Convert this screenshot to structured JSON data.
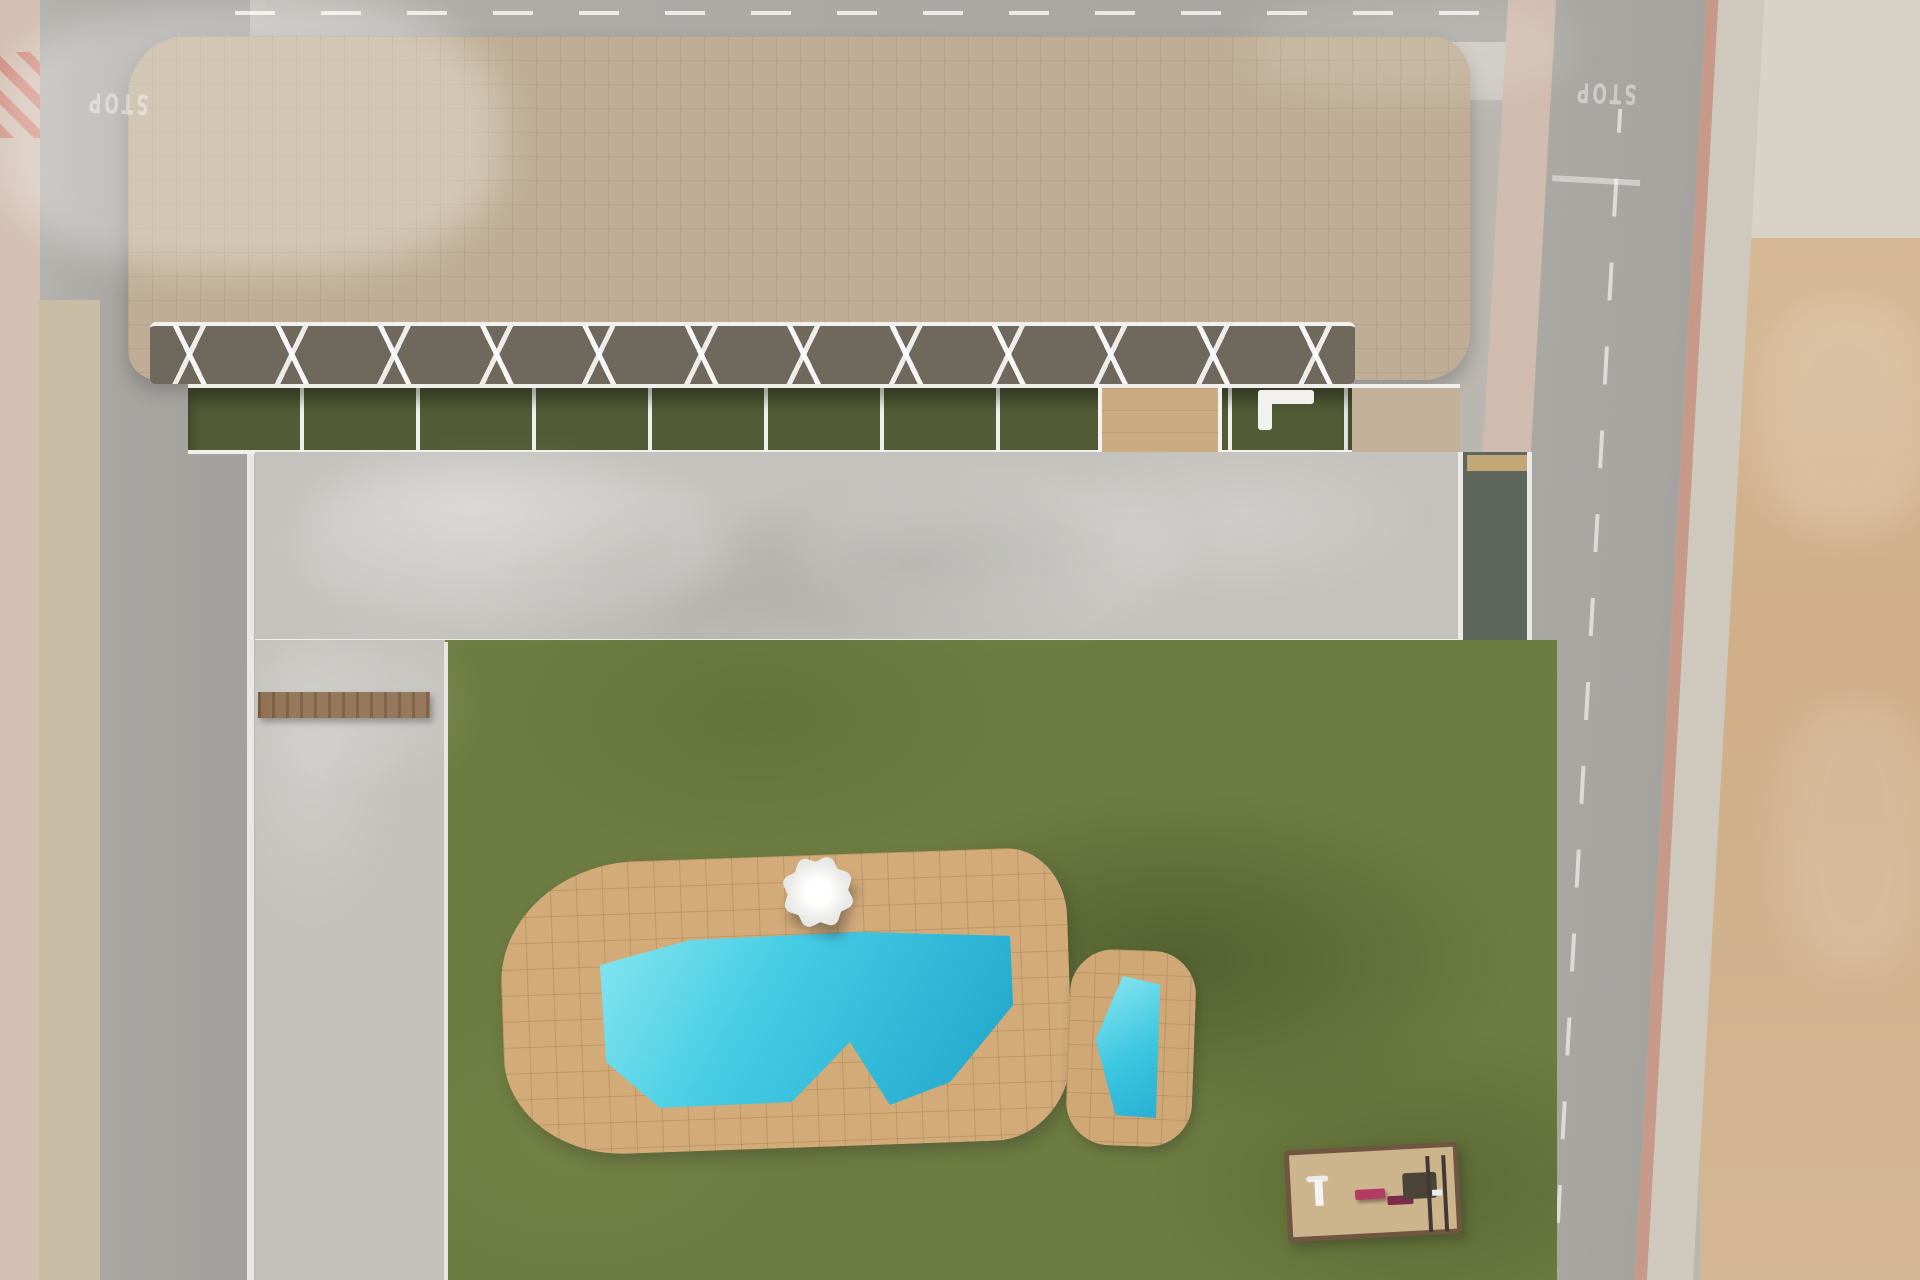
{
  "title": "Aerial render of residential complex with pool garden",
  "road_markings": {
    "stop_label": "STOP"
  },
  "palette": {
    "road": "#a8a6a1",
    "pink_sidewalk": "#d3c0b3",
    "dirt_lot": "#d2b38f",
    "building_pavers": "#bfae95",
    "gravel_roof": "#b3aa9c",
    "white_walls": "#f2f1ed",
    "terrace_grass": "#515b36",
    "lawn": "#6d7c41",
    "pool_water": "#3ec9e2",
    "pool_deck": "#d2ab79",
    "planter_sand": "#d9bd8c",
    "wood": "#8a6038",
    "playground_accent": "#b23b63",
    "bin_blue": "#3a6fc4"
  },
  "scene": {
    "lights": [
      [
        0,
        0,
        500,
        270,
        0.3
      ],
      [
        300,
        468,
        420,
        150,
        0.16
      ],
      [
        800,
        480,
        380,
        140,
        0.12
      ],
      [
        1250,
        0,
        320,
        95,
        0.12
      ],
      [
        1760,
        300,
        170,
        230,
        0.16
      ],
      [
        1780,
        700,
        150,
        270,
        0.12
      ],
      [
        260,
        640,
        195,
        130,
        0.1
      ]
    ],
    "shadows": [
      [
        100,
        140,
        560,
        150,
        -18,
        0.13
      ],
      [
        52,
        520,
        215,
        360,
        -4,
        0.2
      ],
      [
        55,
        860,
        215,
        300,
        -3,
        0.13
      ],
      [
        48,
        1150,
        225,
        140,
        -8,
        0.15
      ],
      [
        258,
        452,
        1200,
        26,
        0,
        0.22
      ],
      [
        520,
        668,
        330,
        100,
        -10,
        0.28
      ],
      [
        880,
        672,
        300,
        90,
        -6,
        0.2
      ],
      [
        1120,
        900,
        340,
        180,
        -14,
        0.25
      ],
      [
        1240,
        1160,
        300,
        120,
        -8,
        0.22
      ],
      [
        330,
        990,
        150,
        230,
        4,
        0.17
      ],
      [
        600,
        1140,
        260,
        120,
        -10,
        0.2
      ],
      [
        910,
        1190,
        270,
        110,
        -6,
        0.2
      ],
      [
        640,
        180,
        330,
        150,
        -8,
        0.14
      ],
      [
        1200,
        200,
        240,
        130,
        -10,
        0.12
      ],
      [
        1700,
        60,
        250,
        230,
        -25,
        0.16
      ],
      [
        1575,
        290,
        140,
        38,
        -6,
        0.28
      ],
      [
        1600,
        985,
        180,
        46,
        -6,
        0.28
      ],
      [
        1000,
        42,
        150,
        32,
        -5,
        0.18
      ],
      [
        470,
        930,
        95,
        210,
        0,
        0.13
      ],
      [
        640,
        1000,
        190,
        95,
        -10,
        0.14
      ],
      [
        900,
        958,
        130,
        125,
        -30,
        0.12
      ],
      [
        262,
        700,
        180,
        200,
        25,
        0.15
      ],
      [
        262,
        1000,
        180,
        260,
        25,
        0.12
      ]
    ],
    "gravel": [
      [
        356,
        40,
        150,
        290,
        18
      ],
      [
        460,
        40,
        128,
        148,
        16
      ],
      [
        962,
        88,
        228,
        250,
        28
      ],
      [
        1348,
        148,
        112,
        184,
        20
      ],
      [
        995,
        60,
        80,
        70,
        10
      ]
    ],
    "green_patches": [
      [
        578,
        226,
        108,
        132,
        10
      ],
      [
        226,
        88,
        54,
        60,
        12
      ],
      [
        1480,
        58,
        46,
        54,
        10
      ]
    ],
    "cores": [
      [
        676,
        14,
        30,
        94
      ],
      [
        712,
        14,
        30,
        94
      ],
      [
        938,
        88,
        28,
        116
      ],
      [
        553,
        148,
        30,
        84
      ],
      [
        1196,
        146,
        28,
        96
      ],
      [
        1078,
        40,
        26,
        60
      ],
      [
        352,
        38,
        10,
        250
      ],
      [
        352,
        38,
        120,
        10
      ]
    ],
    "parapets": [
      [
        150,
        96,
        306,
        240,
        -2,
        38
      ],
      [
        452,
        42,
        252,
        292,
        0,
        42
      ],
      [
        700,
        58,
        258,
        286,
        1,
        40
      ],
      [
        952,
        32,
        252,
        302,
        -1,
        44
      ],
      [
        1188,
        48,
        272,
        286,
        2,
        44
      ],
      [
        136,
        28,
        1330,
        338,
        0,
        54
      ]
    ],
    "planters": [
      [
        300,
        512,
        232,
        86,
        0
      ],
      [
        742,
        506,
        228,
        86,
        0
      ],
      [
        1330,
        565,
        170,
        88,
        3
      ]
    ],
    "crosswalks": [
      [
        82,
        162,
        70,
        44,
        0,
        0
      ],
      [
        1476,
        6,
        72,
        46,
        0,
        1
      ],
      [
        1566,
        124,
        78,
        66,
        3,
        0
      ],
      [
        1656,
        1228,
        152,
        54,
        3,
        0
      ],
      [
        98,
        1242,
        76,
        40,
        0,
        0
      ]
    ],
    "plank_rows": [
      [
        1063,
        727,
        70,
        13,
        6,
        24
      ],
      [
        1106,
        598,
        108,
        10,
        3,
        15
      ],
      [
        1405,
        973,
        74,
        12,
        6,
        23
      ]
    ],
    "bay_lines": [
      [
        352,
        753,
        92,
        3,
        14,
        37
      ]
    ],
    "benches": [
      [
        222,
        640,
        0
      ],
      [
        370,
        610,
        0
      ],
      [
        518,
        610,
        0
      ],
      [
        662,
        607,
        0
      ],
      [
        1050,
        606,
        0
      ],
      [
        1248,
        602,
        0
      ],
      [
        560,
        613,
        1
      ],
      [
        905,
        605,
        1
      ]
    ],
    "streaks": [
      [
        252,
        654,
        25,
        56
      ],
      [
        402,
        657,
        25,
        56
      ],
      [
        550,
        654,
        25,
        56
      ],
      [
        698,
        657,
        25,
        56
      ],
      [
        1012,
        654,
        25,
        56
      ],
      [
        1218,
        650,
        25,
        56
      ],
      [
        1560,
        380,
        -10,
        80
      ],
      [
        1572,
        712,
        -10,
        80
      ],
      [
        1588,
        1044,
        -10,
        80
      ]
    ],
    "roof_tables": [
      [
        292,
        110
      ],
      [
        765,
        152
      ],
      [
        1240,
        302
      ],
      [
        680,
        332
      ],
      [
        950,
        250
      ]
    ],
    "vents": [
      [
        622,
        60
      ],
      [
        705,
        200
      ],
      [
        1205,
        60
      ],
      [
        866,
        60
      ]
    ],
    "lamps": [
      [
        1640,
        368
      ],
      [
        1652,
        700
      ],
      [
        1668,
        1032
      ],
      [
        100,
        672
      ],
      [
        96,
        905
      ]
    ],
    "weeds": [
      [
        60,
        350
      ],
      [
        45,
        430
      ],
      [
        70,
        520
      ],
      [
        52,
        610
      ],
      [
        66,
        700
      ],
      [
        42,
        790
      ],
      [
        64,
        880
      ],
      [
        50,
        960
      ],
      [
        72,
        1040
      ],
      [
        58,
        1120
      ],
      [
        1712,
        350
      ],
      [
        1722,
        500
      ],
      [
        1706,
        640
      ],
      [
        1730,
        800
      ],
      [
        1716,
        950
      ],
      [
        1736,
        1090
      ],
      [
        1708,
        1180
      ]
    ],
    "rocks": [
      [
        1756,
        1160,
        60,
        34,
        10
      ],
      [
        1800,
        1200,
        70,
        40,
        -8
      ],
      [
        1770,
        1240,
        50,
        30,
        0
      ],
      [
        1840,
        1130,
        40,
        26,
        14
      ],
      [
        1815,
        560,
        36,
        22,
        0
      ],
      [
        1790,
        420,
        30,
        18,
        8
      ],
      [
        1850,
        760,
        42,
        24,
        -6
      ],
      [
        1700,
        905,
        26,
        16,
        0
      ]
    ],
    "bins": [
      [
        2,
        574
      ],
      [
        14,
        590
      ],
      [
        34,
        1252
      ],
      [
        52,
        1260
      ]
    ],
    "shrubs": [
      [
        608,
        800,
        34
      ],
      [
        660,
        788,
        28
      ],
      [
        960,
        838,
        34
      ],
      [
        1015,
        845,
        28
      ],
      [
        1110,
        852,
        32
      ],
      [
        1188,
        793,
        30
      ],
      [
        1235,
        768,
        26
      ],
      [
        575,
        755,
        24
      ],
      [
        820,
        800,
        26
      ],
      [
        540,
        1182,
        36
      ],
      [
        594,
        1218,
        30
      ],
      [
        704,
        1266,
        38
      ],
      [
        756,
        1206,
        42
      ],
      [
        856,
        1232,
        38
      ],
      [
        952,
        1192,
        46
      ],
      [
        1150,
        1232,
        38
      ],
      [
        1086,
        1264,
        34
      ],
      [
        1230,
        1102,
        42
      ],
      [
        205,
        622,
        22
      ],
      [
        62,
        1188,
        26
      ],
      [
        78,
        1014,
        20
      ],
      [
        94,
        1258,
        22
      ],
      [
        112,
        148,
        16
      ],
      [
        1545,
        792,
        30
      ],
      [
        1552,
        862,
        32
      ],
      [
        1560,
        935,
        30
      ],
      [
        1572,
        1002,
        34
      ],
      [
        1580,
        1082,
        32
      ],
      [
        1596,
        1152,
        34
      ],
      [
        1600,
        1222,
        34
      ],
      [
        1672,
        284,
        24
      ],
      [
        1752,
        976,
        24
      ],
      [
        1738,
        1128,
        20
      ],
      [
        232,
        96,
        26
      ],
      [
        1492,
        70,
        22
      ]
    ],
    "palms": [
      [
        1056,
        30,
        30
      ],
      [
        1243,
        50,
        34
      ],
      [
        1297,
        17,
        30
      ],
      [
        1700,
        30,
        38
      ],
      [
        1762,
        46,
        30
      ],
      [
        390,
        692,
        60
      ],
      [
        338,
        762,
        46
      ],
      [
        458,
        748,
        40
      ],
      [
        512,
        792,
        54
      ],
      [
        732,
        817,
        48
      ],
      [
        897,
        812,
        52
      ],
      [
        1290,
        810,
        52
      ],
      [
        1360,
        680,
        48
      ],
      [
        452,
        1130,
        58
      ],
      [
        640,
        1247,
        52
      ],
      [
        845,
        1254,
        48
      ],
      [
        418,
        1210,
        40
      ],
      [
        1565,
        902,
        52
      ],
      [
        1604,
        1026,
        56
      ],
      [
        1588,
        1168,
        48
      ],
      [
        1642,
        1252,
        42
      ],
      [
        1532,
        762,
        40
      ],
      [
        1272,
        1088,
        48
      ]
    ],
    "sails": [
      [
        278,
        95,
        84,
        8
      ],
      [
        212,
        288,
        80,
        -12
      ],
      [
        760,
        122,
        86,
        12
      ],
      [
        945,
        118,
        84,
        40
      ],
      [
        1318,
        118,
        80,
        -15
      ],
      [
        1405,
        98,
        78,
        10
      ],
      [
        676,
        293,
        78,
        25
      ],
      [
        803,
        303,
        80,
        -18
      ],
      [
        974,
        304,
        80,
        30
      ],
      [
        1443,
        320,
        72,
        -20
      ],
      [
        497,
        228,
        78,
        36
      ],
      [
        640,
        90,
        60,
        -25
      ]
    ],
    "roof_loungers": [
      [
        300,
        252,
        0
      ],
      [
        322,
        252,
        0
      ],
      [
        520,
        98,
        90
      ],
      [
        548,
        98,
        90
      ],
      [
        880,
        235,
        90
      ],
      [
        610,
        242,
        0
      ],
      [
        905,
        118,
        0
      ],
      [
        1010,
        300,
        90
      ],
      [
        1118,
        258,
        0
      ],
      [
        1142,
        258,
        0
      ],
      [
        1296,
        252,
        90
      ],
      [
        1330,
        92,
        0
      ],
      [
        196,
        98,
        0
      ],
      [
        430,
        255,
        90
      ]
    ],
    "terrace_loungers": [
      [
        228,
        400
      ],
      [
        246,
        406
      ],
      [
        462,
        398
      ],
      [
        480,
        404
      ],
      [
        648,
        400
      ],
      [
        872,
        398
      ],
      [
        890,
        404
      ],
      [
        1052,
        396
      ],
      [
        1070,
        402
      ],
      [
        1236,
        394
      ]
    ],
    "deck_loungers": [
      [
        628,
        966,
        -25,
        0
      ],
      [
        654,
        976,
        -25,
        0
      ],
      [
        700,
        930,
        -60,
        0
      ],
      [
        875,
        912,
        0,
        1
      ],
      [
        897,
        919,
        0,
        1
      ],
      [
        960,
        905,
        90,
        0
      ],
      [
        988,
        905,
        90,
        0
      ],
      [
        545,
        1018,
        -80,
        0
      ]
    ],
    "beanbags": [
      [
        795,
        1098,
        20
      ],
      [
        872,
        1108,
        40
      ],
      [
        1028,
        952,
        10
      ],
      [
        1032,
        1006,
        30
      ],
      [
        683,
        930,
        15
      ]
    ],
    "cars": [
      [
        352,
        893,
        92,
        38,
        "#e8e9ea",
        0
      ],
      [
        352,
        1001,
        92,
        38,
        "#2c2e32",
        0
      ],
      [
        352,
        1110,
        92,
        38,
        "#313439",
        0
      ],
      [
        1464,
        640,
        44,
        84,
        "#eceeef",
        1
      ],
      [
        1424,
        16,
        50,
        106,
        "#23252b",
        1
      ]
    ]
  }
}
